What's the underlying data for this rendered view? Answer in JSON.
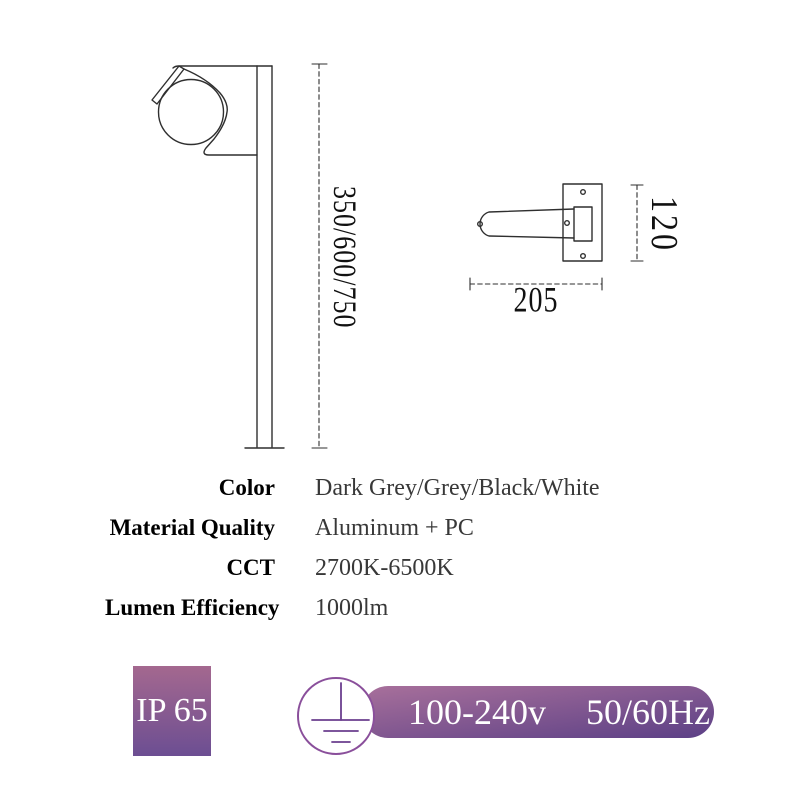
{
  "drawings": {
    "side_view": {
      "height_label": "350/600/750"
    },
    "top_view": {
      "width_label": "205",
      "height_label": "120"
    }
  },
  "specs": {
    "rows": [
      {
        "label": "Color",
        "value": "Dark Grey/Grey/Black/White"
      },
      {
        "label": "Material Quality",
        "value": "Aluminum + PC"
      },
      {
        "label": "CCT",
        "value": "2700K-6500K"
      },
      {
        "label": "Lumen Efficiency",
        "value": "1000lm"
      }
    ]
  },
  "badges": {
    "ip_rating": "IP 65",
    "voltage": "100-240v",
    "frequency": "50/60Hz"
  },
  "colors": {
    "badge-top": "#a4688f",
    "badge-bottom": "#6c4e92",
    "pill-top": "#a8709b",
    "pill-bottom": "#5c4086",
    "ground-ring": "#8a4f9b",
    "ground-line": "#6b3f8f",
    "drawing-line": "#2f2f2f"
  }
}
